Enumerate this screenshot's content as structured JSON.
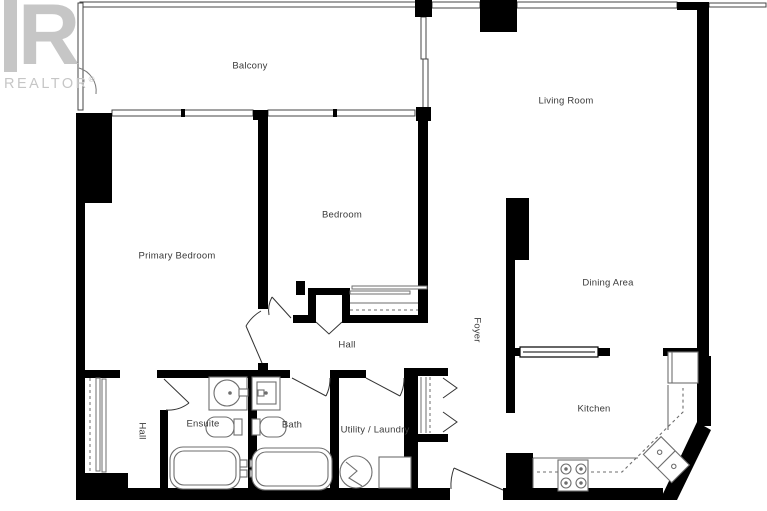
{
  "watermark": {
    "logo_letter": "R",
    "brand": "REALTOR",
    "registered": "®",
    "color": "#c6c6c6"
  },
  "palette": {
    "wall": "#000000",
    "thin_line": "#444444",
    "fixture_line": "#6e6e6e",
    "label_text": "#3a3a3a",
    "background": "#ffffff"
  },
  "rooms": [
    {
      "label": "Balcony"
    },
    {
      "label": "Living Room"
    },
    {
      "label": "Bedroom"
    },
    {
      "label": "Primary Bedroom"
    },
    {
      "label": "Dining Area"
    },
    {
      "label": "Foyer"
    },
    {
      "label": "Hall"
    },
    {
      "label": "Hall"
    },
    {
      "label": "Ensuite"
    },
    {
      "label": "Bath"
    },
    {
      "label": "Utility / Laundry"
    },
    {
      "label": "Kitchen"
    }
  ]
}
